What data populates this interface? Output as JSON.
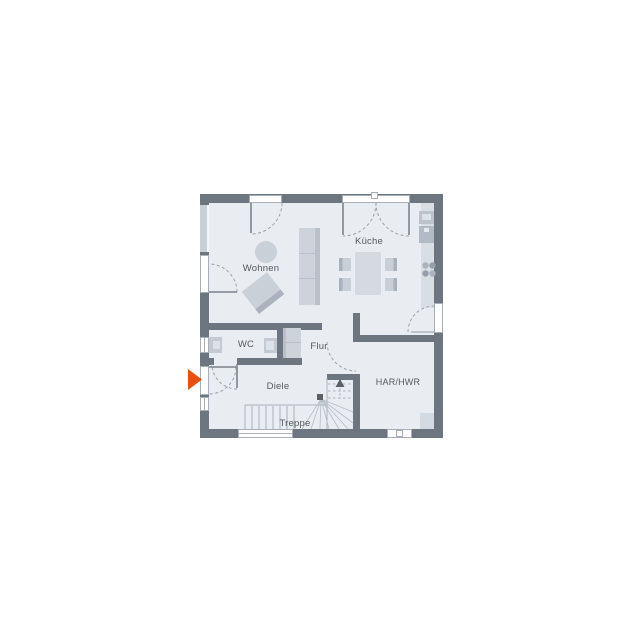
{
  "rooms": {
    "wohnen": "Wohnen",
    "kueche": "Küche",
    "wc": "WC",
    "flur": "Flur",
    "diele": "Diele",
    "har_hwr": "HAR/HWR",
    "treppe": "Treppe"
  },
  "icons": {
    "entrance_arrow": "entrance-direction-arrow",
    "stairs_up_arrow": "stairs-up-arrow",
    "door_swing": "door-swing-arc",
    "cooktop": "cooktop-burners"
  },
  "colors": {
    "wall": "#6d7580",
    "floor": "#e9edf2",
    "window_band": "#c9cfd7",
    "opening_frame": "#a8aeb8",
    "furniture": "#cdd3db",
    "furniture_shade": "#aab2be",
    "stair_lines": "#aab0ba",
    "label_text": "#555a61",
    "entrance_arrow": "#e8500f",
    "dark_marks": "#5b6068"
  }
}
